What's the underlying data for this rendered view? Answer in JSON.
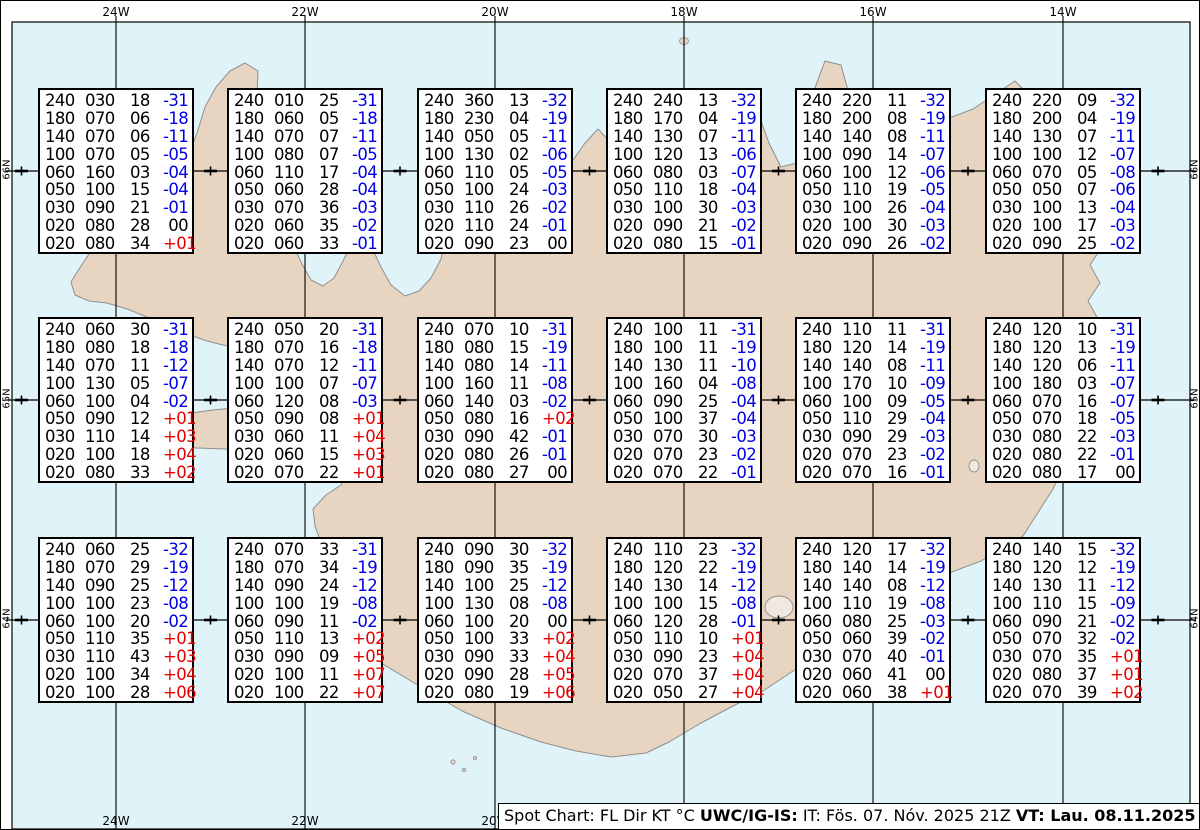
{
  "graticule": {
    "top_labels": [
      "24W",
      "22W",
      "20W",
      "18W",
      "16W",
      "14W"
    ],
    "bottom_labels": [
      "24W",
      "22W",
      "20W"
    ],
    "left_labels": [
      "66N",
      "65N",
      "64N"
    ],
    "right_labels": [
      "66N",
      "65N",
      "64N"
    ]
  },
  "caption": {
    "prefix": "Spot Chart: FL Dir KT °C ",
    "bold1": "UWC/IG-IS:",
    "mid": " IT: Fös. 07. Nóv. 2025 21Z ",
    "bold2": "VT: Lau. 08.11.2025 20Z",
    "suffix": " (+23 h)"
  },
  "legend_columns": [
    "FL",
    "Dir",
    "KT",
    "°C"
  ],
  "colors": {
    "water": "#dff3f8",
    "land": "#e8d5c1",
    "coastline": "#8f8f8f",
    "grid": "#000000",
    "box_border": "#000000",
    "temp_negative": "#0000e6",
    "temp_positive": "#e60000",
    "temp_zero": "#000000"
  },
  "spot_grid": [
    [
      [
        [
          "240",
          "030",
          "18",
          "-31"
        ],
        [
          "180",
          "070",
          "06",
          "-18"
        ],
        [
          "140",
          "070",
          "06",
          "-11"
        ],
        [
          "100",
          "070",
          "05",
          "-05"
        ],
        [
          "060",
          "160",
          "03",
          "-04"
        ],
        [
          "050",
          "100",
          "15",
          "-04"
        ],
        [
          "030",
          "090",
          "21",
          "-01"
        ],
        [
          "020",
          "080",
          "28",
          "00"
        ],
        [
          "020",
          "080",
          "34",
          "+01"
        ]
      ],
      [
        [
          "240",
          "010",
          "25",
          "-31"
        ],
        [
          "180",
          "060",
          "05",
          "-18"
        ],
        [
          "140",
          "070",
          "07",
          "-11"
        ],
        [
          "100",
          "080",
          "07",
          "-05"
        ],
        [
          "060",
          "110",
          "17",
          "-04"
        ],
        [
          "050",
          "060",
          "28",
          "-04"
        ],
        [
          "030",
          "070",
          "36",
          "-03"
        ],
        [
          "020",
          "060",
          "35",
          "-02"
        ],
        [
          "020",
          "060",
          "33",
          "-01"
        ]
      ],
      [
        [
          "240",
          "360",
          "13",
          "-32"
        ],
        [
          "180",
          "230",
          "04",
          "-19"
        ],
        [
          "140",
          "050",
          "05",
          "-11"
        ],
        [
          "100",
          "130",
          "02",
          "-06"
        ],
        [
          "060",
          "110",
          "05",
          "-05"
        ],
        [
          "050",
          "100",
          "24",
          "-03"
        ],
        [
          "030",
          "110",
          "26",
          "-02"
        ],
        [
          "020",
          "110",
          "24",
          "-01"
        ],
        [
          "020",
          "090",
          "23",
          "00"
        ]
      ],
      [
        [
          "240",
          "240",
          "13",
          "-32"
        ],
        [
          "180",
          "170",
          "04",
          "-19"
        ],
        [
          "140",
          "130",
          "07",
          "-11"
        ],
        [
          "100",
          "120",
          "13",
          "-06"
        ],
        [
          "060",
          "080",
          "03",
          "-07"
        ],
        [
          "050",
          "110",
          "18",
          "-04"
        ],
        [
          "030",
          "100",
          "30",
          "-03"
        ],
        [
          "020",
          "090",
          "21",
          "-02"
        ],
        [
          "020",
          "080",
          "15",
          "-01"
        ]
      ],
      [
        [
          "240",
          "220",
          "11",
          "-32"
        ],
        [
          "180",
          "200",
          "08",
          "-19"
        ],
        [
          "140",
          "140",
          "08",
          "-11"
        ],
        [
          "100",
          "090",
          "14",
          "-07"
        ],
        [
          "060",
          "100",
          "12",
          "-06"
        ],
        [
          "050",
          "110",
          "19",
          "-05"
        ],
        [
          "030",
          "100",
          "26",
          "-04"
        ],
        [
          "020",
          "100",
          "30",
          "-03"
        ],
        [
          "020",
          "090",
          "26",
          "-02"
        ]
      ],
      [
        [
          "240",
          "220",
          "09",
          "-32"
        ],
        [
          "180",
          "200",
          "04",
          "-19"
        ],
        [
          "140",
          "130",
          "07",
          "-11"
        ],
        [
          "100",
          "100",
          "12",
          "-07"
        ],
        [
          "060",
          "070",
          "05",
          "-08"
        ],
        [
          "050",
          "050",
          "07",
          "-06"
        ],
        [
          "030",
          "100",
          "13",
          "-04"
        ],
        [
          "020",
          "100",
          "17",
          "-03"
        ],
        [
          "020",
          "090",
          "25",
          "-02"
        ]
      ]
    ],
    [
      [
        [
          "240",
          "060",
          "30",
          "-31"
        ],
        [
          "180",
          "080",
          "18",
          "-18"
        ],
        [
          "140",
          "070",
          "11",
          "-12"
        ],
        [
          "100",
          "130",
          "05",
          "-07"
        ],
        [
          "060",
          "100",
          "04",
          "-02"
        ],
        [
          "050",
          "090",
          "12",
          "+01"
        ],
        [
          "030",
          "110",
          "14",
          "+03"
        ],
        [
          "020",
          "100",
          "18",
          "+04"
        ],
        [
          "020",
          "080",
          "33",
          "+02"
        ]
      ],
      [
        [
          "240",
          "050",
          "20",
          "-31"
        ],
        [
          "180",
          "070",
          "16",
          "-18"
        ],
        [
          "140",
          "070",
          "12",
          "-11"
        ],
        [
          "100",
          "100",
          "07",
          "-07"
        ],
        [
          "060",
          "120",
          "08",
          "-03"
        ],
        [
          "050",
          "090",
          "08",
          "+01"
        ],
        [
          "030",
          "060",
          "11",
          "+04"
        ],
        [
          "020",
          "060",
          "15",
          "+03"
        ],
        [
          "020",
          "070",
          "22",
          "+01"
        ]
      ],
      [
        [
          "240",
          "070",
          "10",
          "-31"
        ],
        [
          "180",
          "080",
          "15",
          "-19"
        ],
        [
          "140",
          "080",
          "14",
          "-11"
        ],
        [
          "100",
          "160",
          "11",
          "-08"
        ],
        [
          "060",
          "140",
          "03",
          "-02"
        ],
        [
          "050",
          "080",
          "16",
          "+02"
        ],
        [
          "030",
          "090",
          "42",
          "-01"
        ],
        [
          "020",
          "080",
          "26",
          "-01"
        ],
        [
          "020",
          "080",
          "27",
          "00"
        ]
      ],
      [
        [
          "240",
          "100",
          "11",
          "-31"
        ],
        [
          "180",
          "100",
          "11",
          "-19"
        ],
        [
          "140",
          "130",
          "11",
          "-10"
        ],
        [
          "100",
          "160",
          "04",
          "-08"
        ],
        [
          "060",
          "090",
          "25",
          "-04"
        ],
        [
          "050",
          "100",
          "37",
          "-04"
        ],
        [
          "030",
          "070",
          "30",
          "-03"
        ],
        [
          "020",
          "070",
          "23",
          "-02"
        ],
        [
          "020",
          "070",
          "22",
          "-01"
        ]
      ],
      [
        [
          "240",
          "110",
          "11",
          "-31"
        ],
        [
          "180",
          "120",
          "14",
          "-19"
        ],
        [
          "140",
          "140",
          "08",
          "-11"
        ],
        [
          "100",
          "170",
          "10",
          "-09"
        ],
        [
          "060",
          "100",
          "09",
          "-05"
        ],
        [
          "050",
          "110",
          "29",
          "-04"
        ],
        [
          "030",
          "090",
          "29",
          "-03"
        ],
        [
          "020",
          "070",
          "23",
          "-02"
        ],
        [
          "020",
          "070",
          "16",
          "-01"
        ]
      ],
      [
        [
          "240",
          "120",
          "10",
          "-31"
        ],
        [
          "180",
          "120",
          "13",
          "-19"
        ],
        [
          "140",
          "120",
          "06",
          "-11"
        ],
        [
          "100",
          "180",
          "03",
          "-07"
        ],
        [
          "060",
          "070",
          "16",
          "-07"
        ],
        [
          "050",
          "070",
          "18",
          "-05"
        ],
        [
          "030",
          "080",
          "22",
          "-03"
        ],
        [
          "020",
          "080",
          "22",
          "-01"
        ],
        [
          "020",
          "080",
          "17",
          "00"
        ]
      ]
    ],
    [
      [
        [
          "240",
          "060",
          "25",
          "-32"
        ],
        [
          "180",
          "070",
          "29",
          "-19"
        ],
        [
          "140",
          "090",
          "25",
          "-12"
        ],
        [
          "100",
          "100",
          "23",
          "-08"
        ],
        [
          "060",
          "100",
          "20",
          "-02"
        ],
        [
          "050",
          "110",
          "35",
          "+01"
        ],
        [
          "030",
          "110",
          "43",
          "+03"
        ],
        [
          "020",
          "100",
          "34",
          "+04"
        ],
        [
          "020",
          "100",
          "28",
          "+06"
        ]
      ],
      [
        [
          "240",
          "070",
          "33",
          "-31"
        ],
        [
          "180",
          "070",
          "34",
          "-19"
        ],
        [
          "140",
          "090",
          "24",
          "-12"
        ],
        [
          "100",
          "100",
          "19",
          "-08"
        ],
        [
          "060",
          "090",
          "11",
          "-02"
        ],
        [
          "050",
          "110",
          "13",
          "+02"
        ],
        [
          "030",
          "090",
          "09",
          "+05"
        ],
        [
          "020",
          "100",
          "11",
          "+07"
        ],
        [
          "020",
          "100",
          "22",
          "+07"
        ]
      ],
      [
        [
          "240",
          "090",
          "30",
          "-32"
        ],
        [
          "180",
          "090",
          "35",
          "-19"
        ],
        [
          "140",
          "100",
          "25",
          "-12"
        ],
        [
          "100",
          "130",
          "08",
          "-08"
        ],
        [
          "060",
          "100",
          "20",
          "00"
        ],
        [
          "050",
          "100",
          "33",
          "+02"
        ],
        [
          "030",
          "090",
          "33",
          "+04"
        ],
        [
          "020",
          "090",
          "28",
          "+05"
        ],
        [
          "020",
          "080",
          "19",
          "+06"
        ]
      ],
      [
        [
          "240",
          "110",
          "23",
          "-32"
        ],
        [
          "180",
          "120",
          "22",
          "-19"
        ],
        [
          "140",
          "130",
          "14",
          "-12"
        ],
        [
          "100",
          "100",
          "15",
          "-08"
        ],
        [
          "060",
          "120",
          "28",
          "-01"
        ],
        [
          "050",
          "110",
          "10",
          "+01"
        ],
        [
          "030",
          "090",
          "23",
          "+04"
        ],
        [
          "020",
          "070",
          "37",
          "+04"
        ],
        [
          "020",
          "050",
          "27",
          "+04"
        ]
      ],
      [
        [
          "240",
          "120",
          "17",
          "-32"
        ],
        [
          "180",
          "140",
          "14",
          "-19"
        ],
        [
          "140",
          "140",
          "08",
          "-12"
        ],
        [
          "100",
          "110",
          "19",
          "-08"
        ],
        [
          "060",
          "080",
          "25",
          "-03"
        ],
        [
          "050",
          "060",
          "39",
          "-02"
        ],
        [
          "030",
          "070",
          "40",
          "-01"
        ],
        [
          "020",
          "060",
          "41",
          "00"
        ],
        [
          "020",
          "060",
          "38",
          "+01"
        ]
      ],
      [
        [
          "240",
          "140",
          "15",
          "-32"
        ],
        [
          "180",
          "120",
          "12",
          "-19"
        ],
        [
          "140",
          "130",
          "11",
          "-12"
        ],
        [
          "100",
          "110",
          "15",
          "-09"
        ],
        [
          "060",
          "090",
          "21",
          "-02"
        ],
        [
          "050",
          "070",
          "32",
          "-02"
        ],
        [
          "030",
          "070",
          "35",
          "+01"
        ],
        [
          "020",
          "080",
          "37",
          "+01"
        ],
        [
          "020",
          "070",
          "39",
          "+02"
        ]
      ]
    ]
  ]
}
